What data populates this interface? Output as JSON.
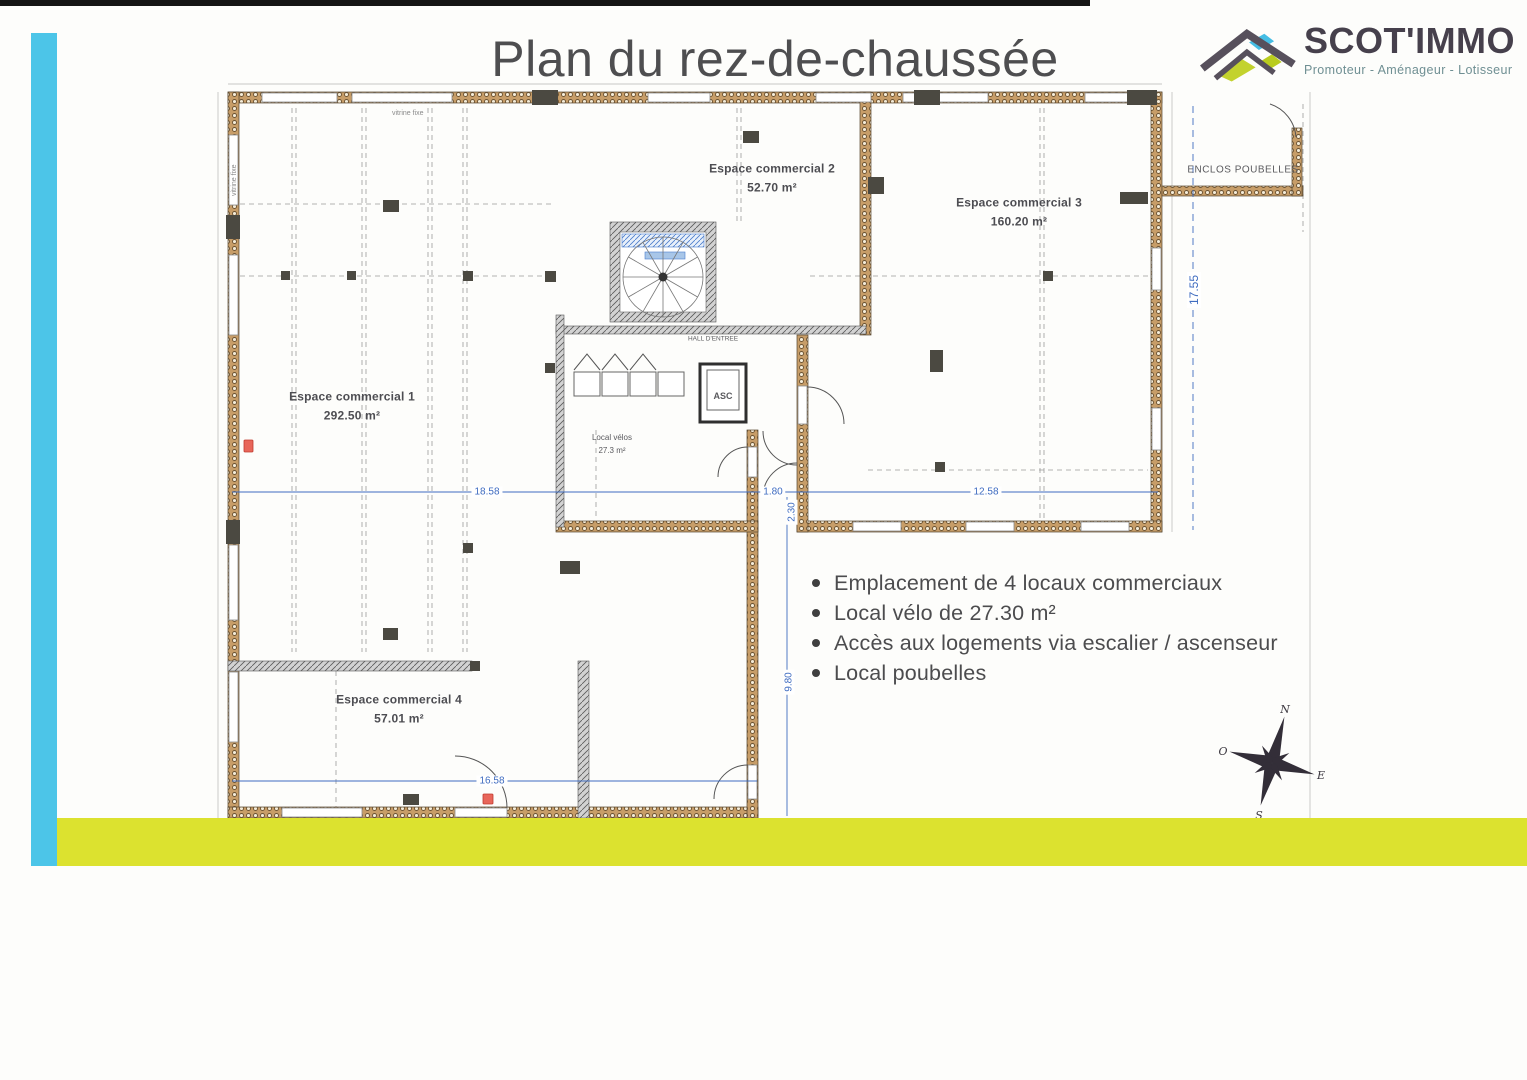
{
  "header": {
    "title": "Plan du rez-de-chaussée"
  },
  "logo": {
    "name": "SCOT'IMMO",
    "tagline": "Promoteur - Aménageur - Lotisseur"
  },
  "rooms": {
    "r1": {
      "name": "Espace commercial 1",
      "area": "292.50 m²"
    },
    "r2": {
      "name": "Espace commercial 2",
      "area": "52.70 m²"
    },
    "r3": {
      "name": "Espace commercial 3",
      "area": "160.20 m²"
    },
    "r4": {
      "name": "Espace commercial 4",
      "area": "57.01 m²"
    },
    "enclos": {
      "name": "ENCLOS POUBELLES"
    },
    "velos": {
      "name": "Local vélos",
      "area": "27.3 m²"
    },
    "asc": {
      "name": "ASC"
    },
    "hall": {
      "name": "HALL D'ENTREE"
    }
  },
  "dimensions": {
    "width_left": "18.58",
    "entrance": "1.80",
    "width_right": "12.58",
    "entrance_depth": "2.30",
    "right_height": "17.55",
    "bottom_height": "9.80",
    "bottom_width": "16.58"
  },
  "annotations": {
    "vitrine_top": "vitrine fixe",
    "vitrine_left": "vitrine fixe"
  },
  "compass": {
    "n": "N",
    "s": "S",
    "e": "E",
    "o": "O"
  },
  "notes": [
    "Emplacement de 4 locaux commerciaux",
    "Local vélo de 27.30 m²",
    "Accès aux logements via escalier / ascenseur",
    "Local poubelles"
  ],
  "colors": {
    "stripe_blue": "#4cc5e8",
    "stripe_yellow": "#dce22f",
    "dimension_blue": "#3f6cc0",
    "wall_tan": "#c79d68",
    "logo_blue": "#45bde4",
    "logo_green": "#c3d22e"
  }
}
